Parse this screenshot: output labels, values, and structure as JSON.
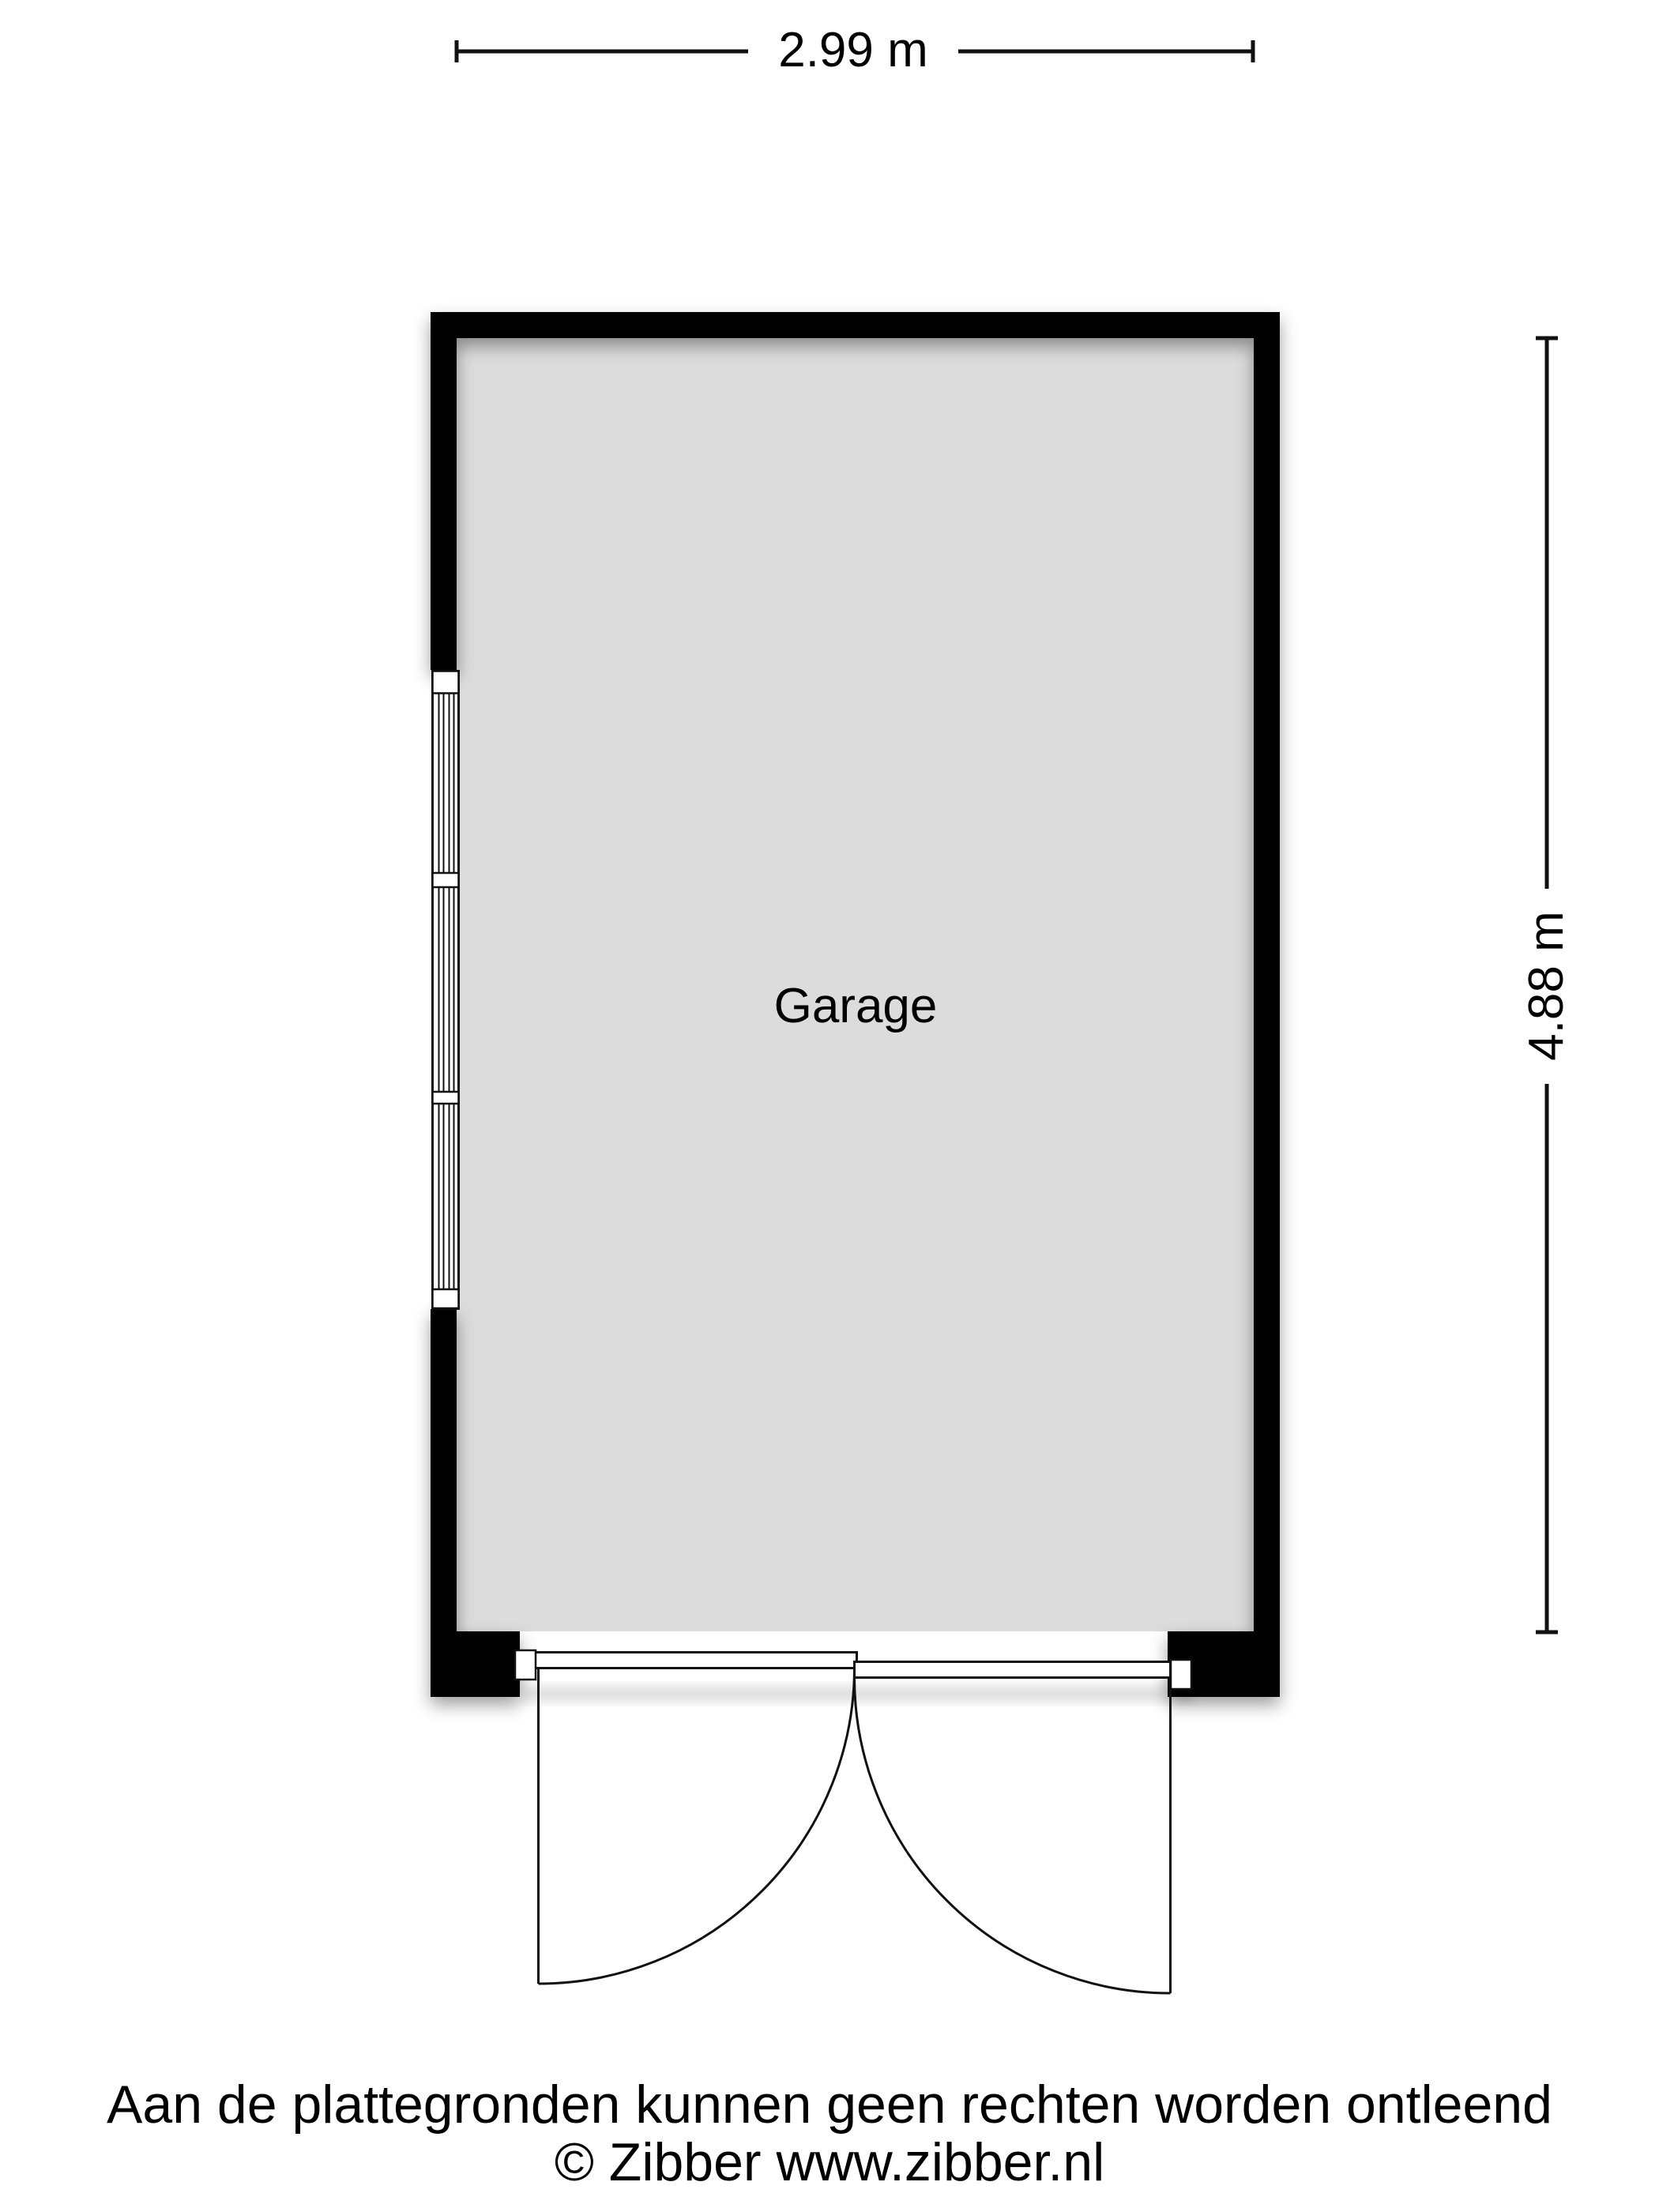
{
  "colors": {
    "wall": "#000000",
    "room_fill": "#dcdcdc",
    "line": "#111111",
    "text": "#000000",
    "window_fill": "#ffffff",
    "background": "#ffffff"
  },
  "plan": {
    "room_label": "Garage",
    "width_dimension": "2.99 m",
    "height_dimension": "4.88 m"
  },
  "footer": {
    "disclaimer": "Aan de plattegronden kunnen geen rechten worden ontleend",
    "copyright": "© Zibber www.zibber.nl"
  }
}
